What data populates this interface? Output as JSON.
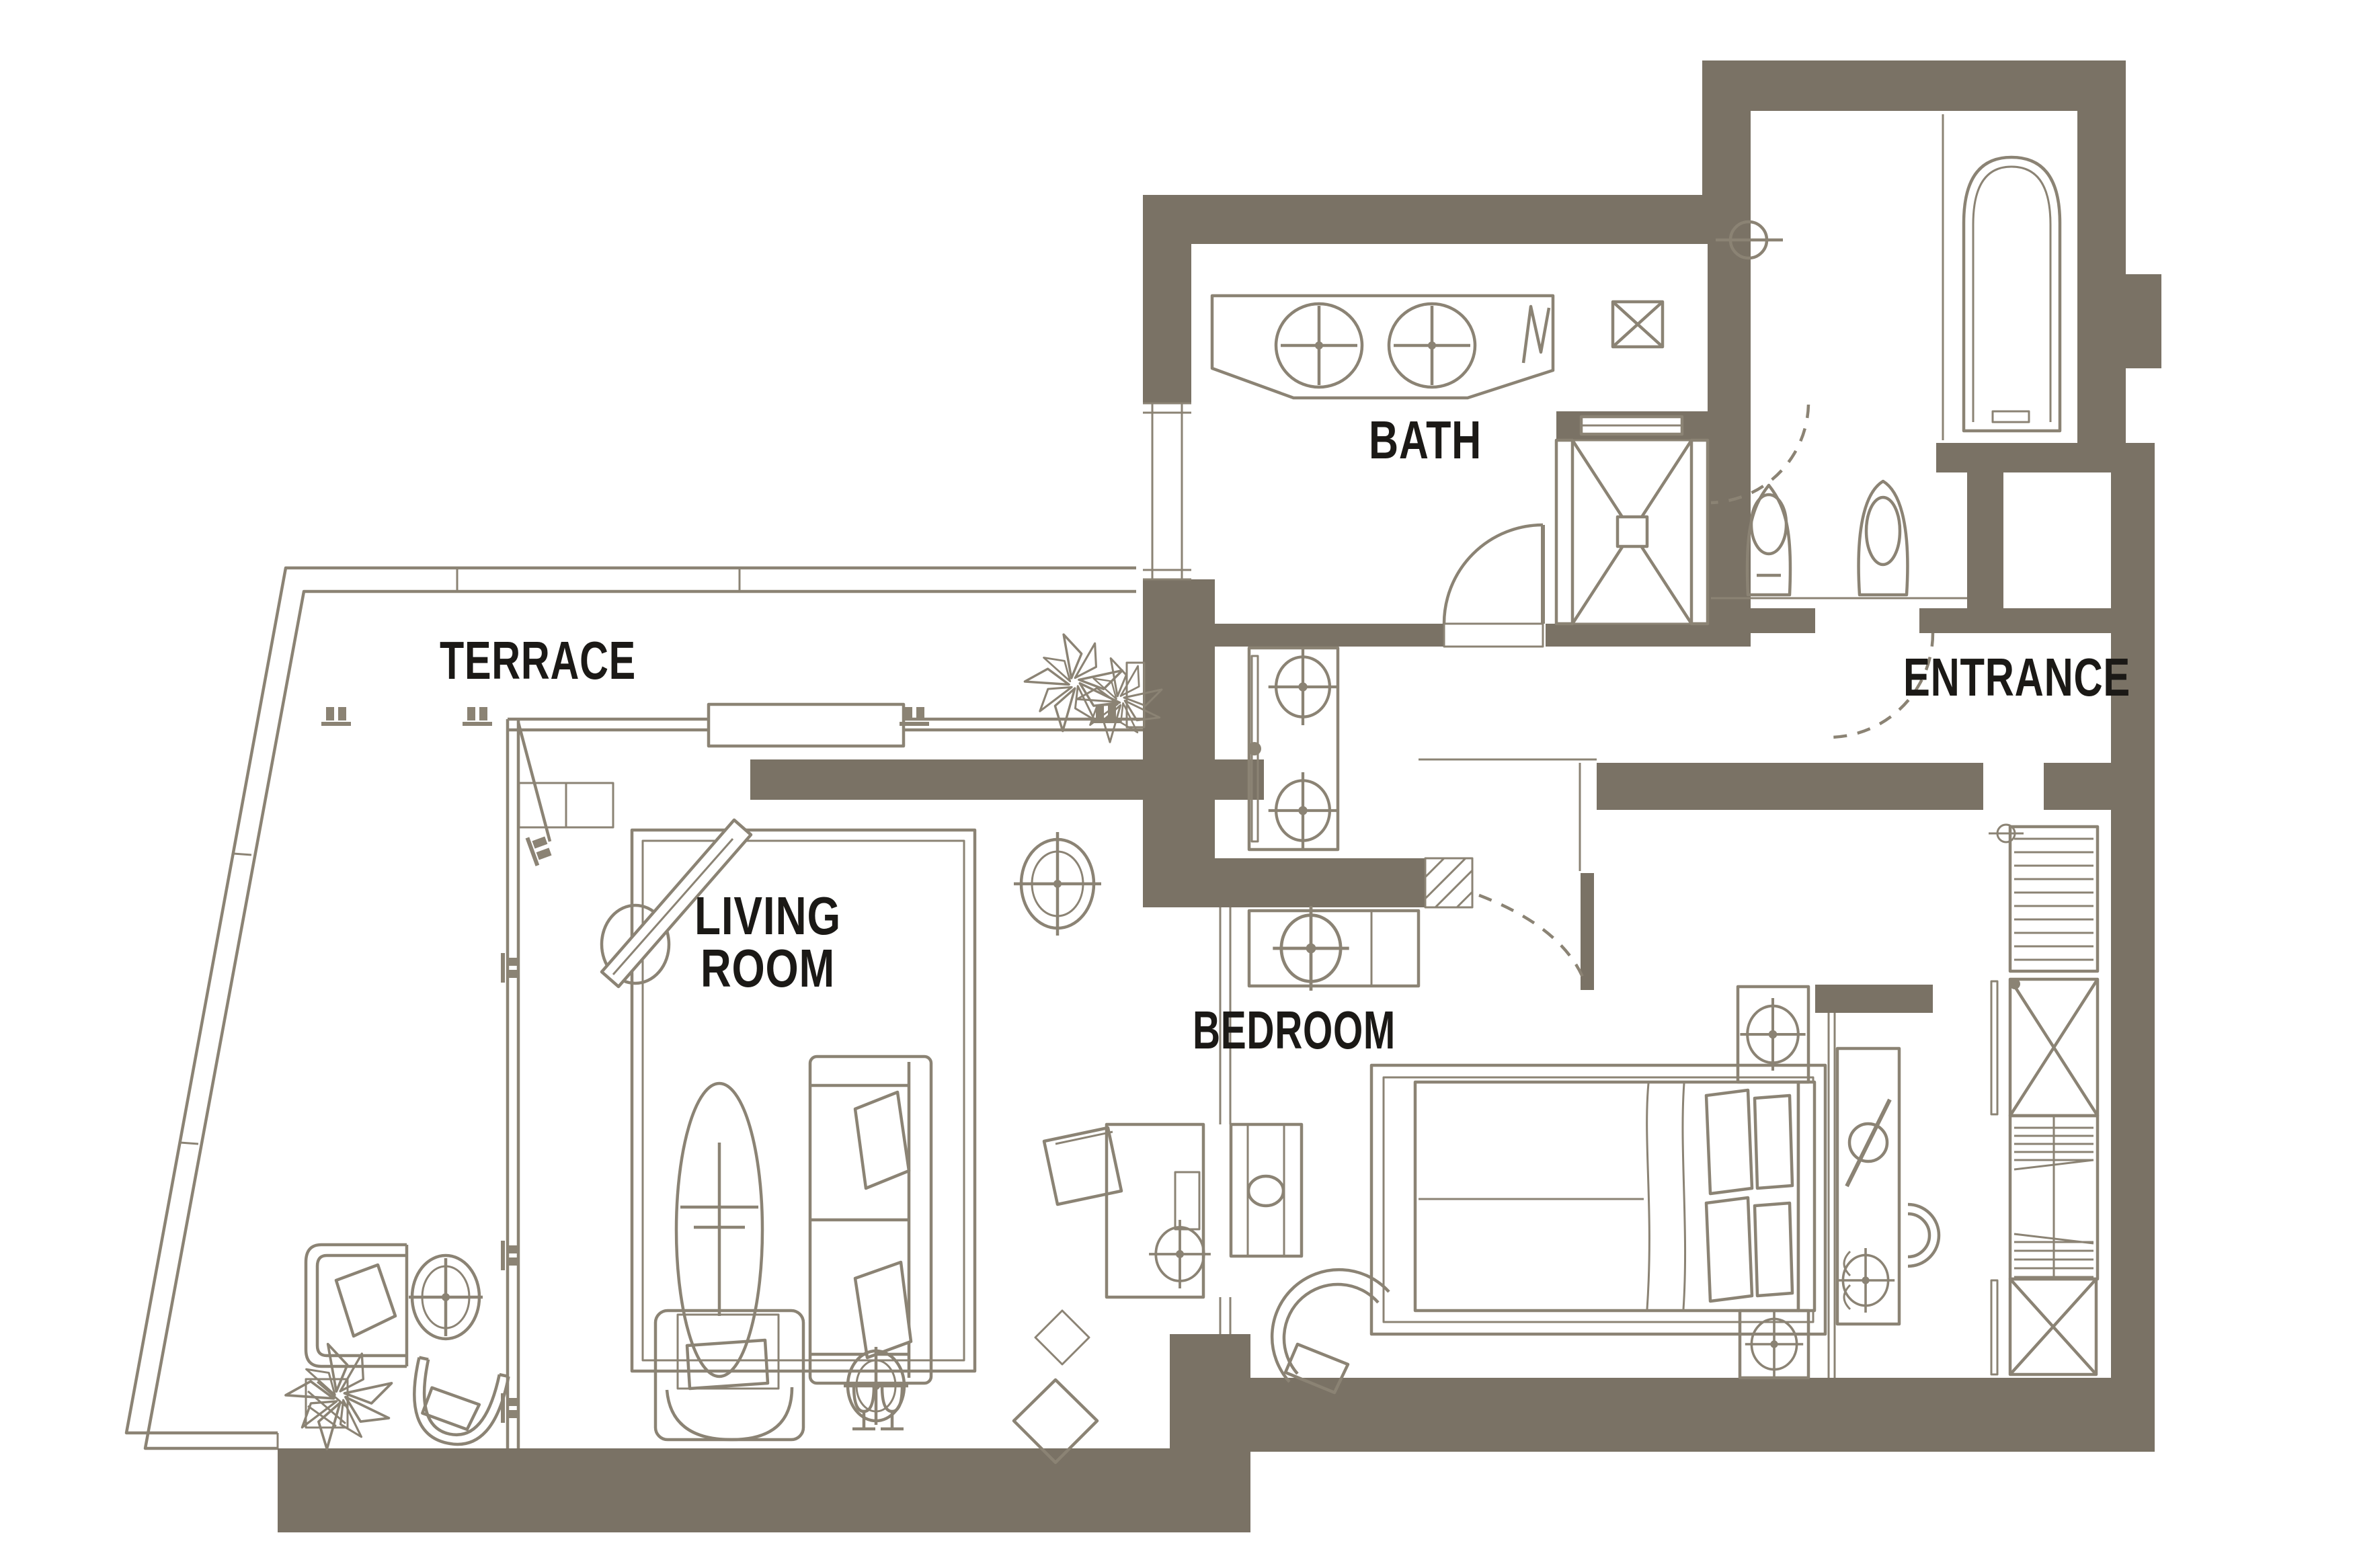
{
  "page": {
    "type": "apartment-floor-plan"
  },
  "theme": {
    "wall_color": "#7a7265",
    "line_color": "#8b8374",
    "label_color": "#1b1916",
    "background": "#ffffff"
  },
  "rooms": {
    "terrace": {
      "label": "TERRACE"
    },
    "bath": {
      "label": "BATH"
    },
    "entrance": {
      "label": "ENTRANCE"
    },
    "living_room": {
      "label_line1": "LIVING",
      "label_line2": "ROOM"
    },
    "bedroom": {
      "label": "BEDROOM"
    }
  },
  "fixtures": {
    "terrace": [
      "glass-balustrade",
      "sliding-door-rail",
      "sliding-panel",
      "door-handles",
      "palm-plants",
      "planter-box",
      "lounge-chair",
      "side-table",
      "tub-chair",
      "potted-plant"
    ],
    "bath": [
      "vanity-counter",
      "double-sinks",
      "towel-symbol",
      "wall-niche",
      "shower-enclosure",
      "bath-door",
      "wc-door",
      "toilet",
      "bidet",
      "bathtub",
      "tub-filler",
      "window"
    ],
    "corridor": [
      "storage-console",
      "sliding-door",
      "knobs"
    ],
    "entrance": [
      "entry-door-swing"
    ],
    "living_room": [
      "rug",
      "wall-mounted-tv",
      "media-curve",
      "corner-shelf",
      "ceiling-light",
      "coffee-table-with-plant",
      "sofa",
      "cushions",
      "armchair",
      "side-table",
      "floor-diamonds",
      "glass-sconces",
      "desk",
      "desk-chair"
    ],
    "bedroom": [
      "entry-door",
      "cabinet",
      "rug",
      "double-bed",
      "pillows",
      "headboard",
      "nightstand-north",
      "nightstand-south",
      "tv-console",
      "dressing-table",
      "mirror",
      "stool",
      "tub-chair",
      "wardrobe-shelves",
      "wardrobe-cabinets"
    ]
  }
}
